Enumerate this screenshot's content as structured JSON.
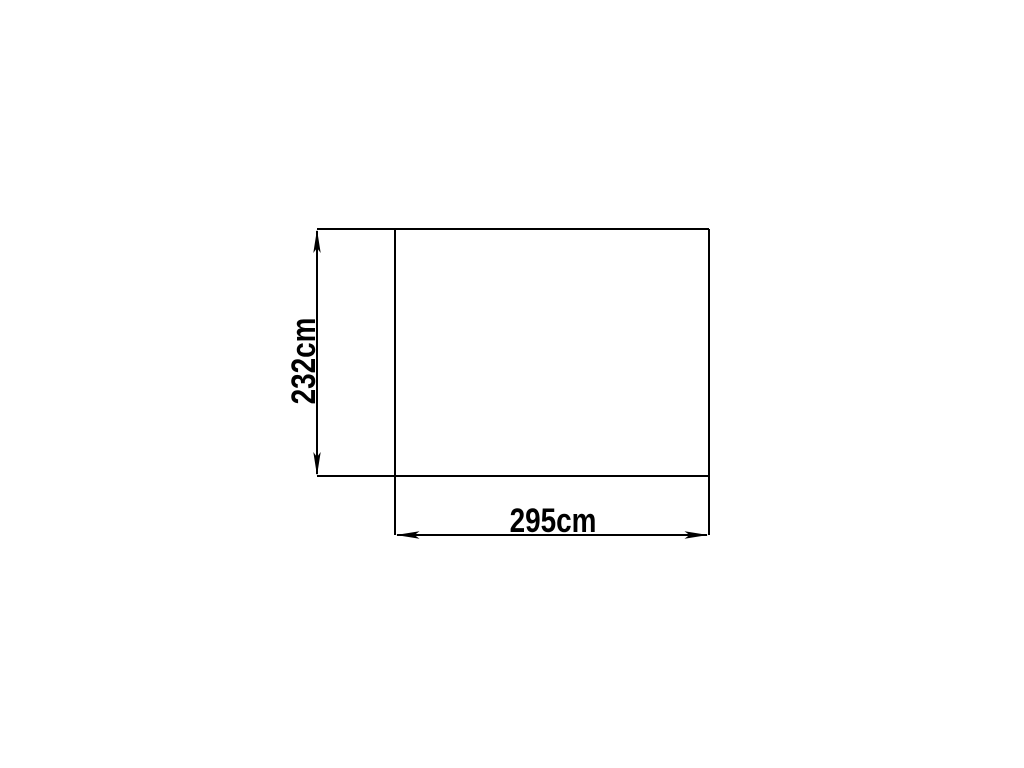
{
  "diagram": {
    "type": "dimension-drawing",
    "shape": "rectangle",
    "width_label": "295cm",
    "height_label": "232cm",
    "width_value_cm": 295,
    "height_value_cm": 232,
    "line_color": "#000000",
    "background_color": "#ffffff"
  }
}
